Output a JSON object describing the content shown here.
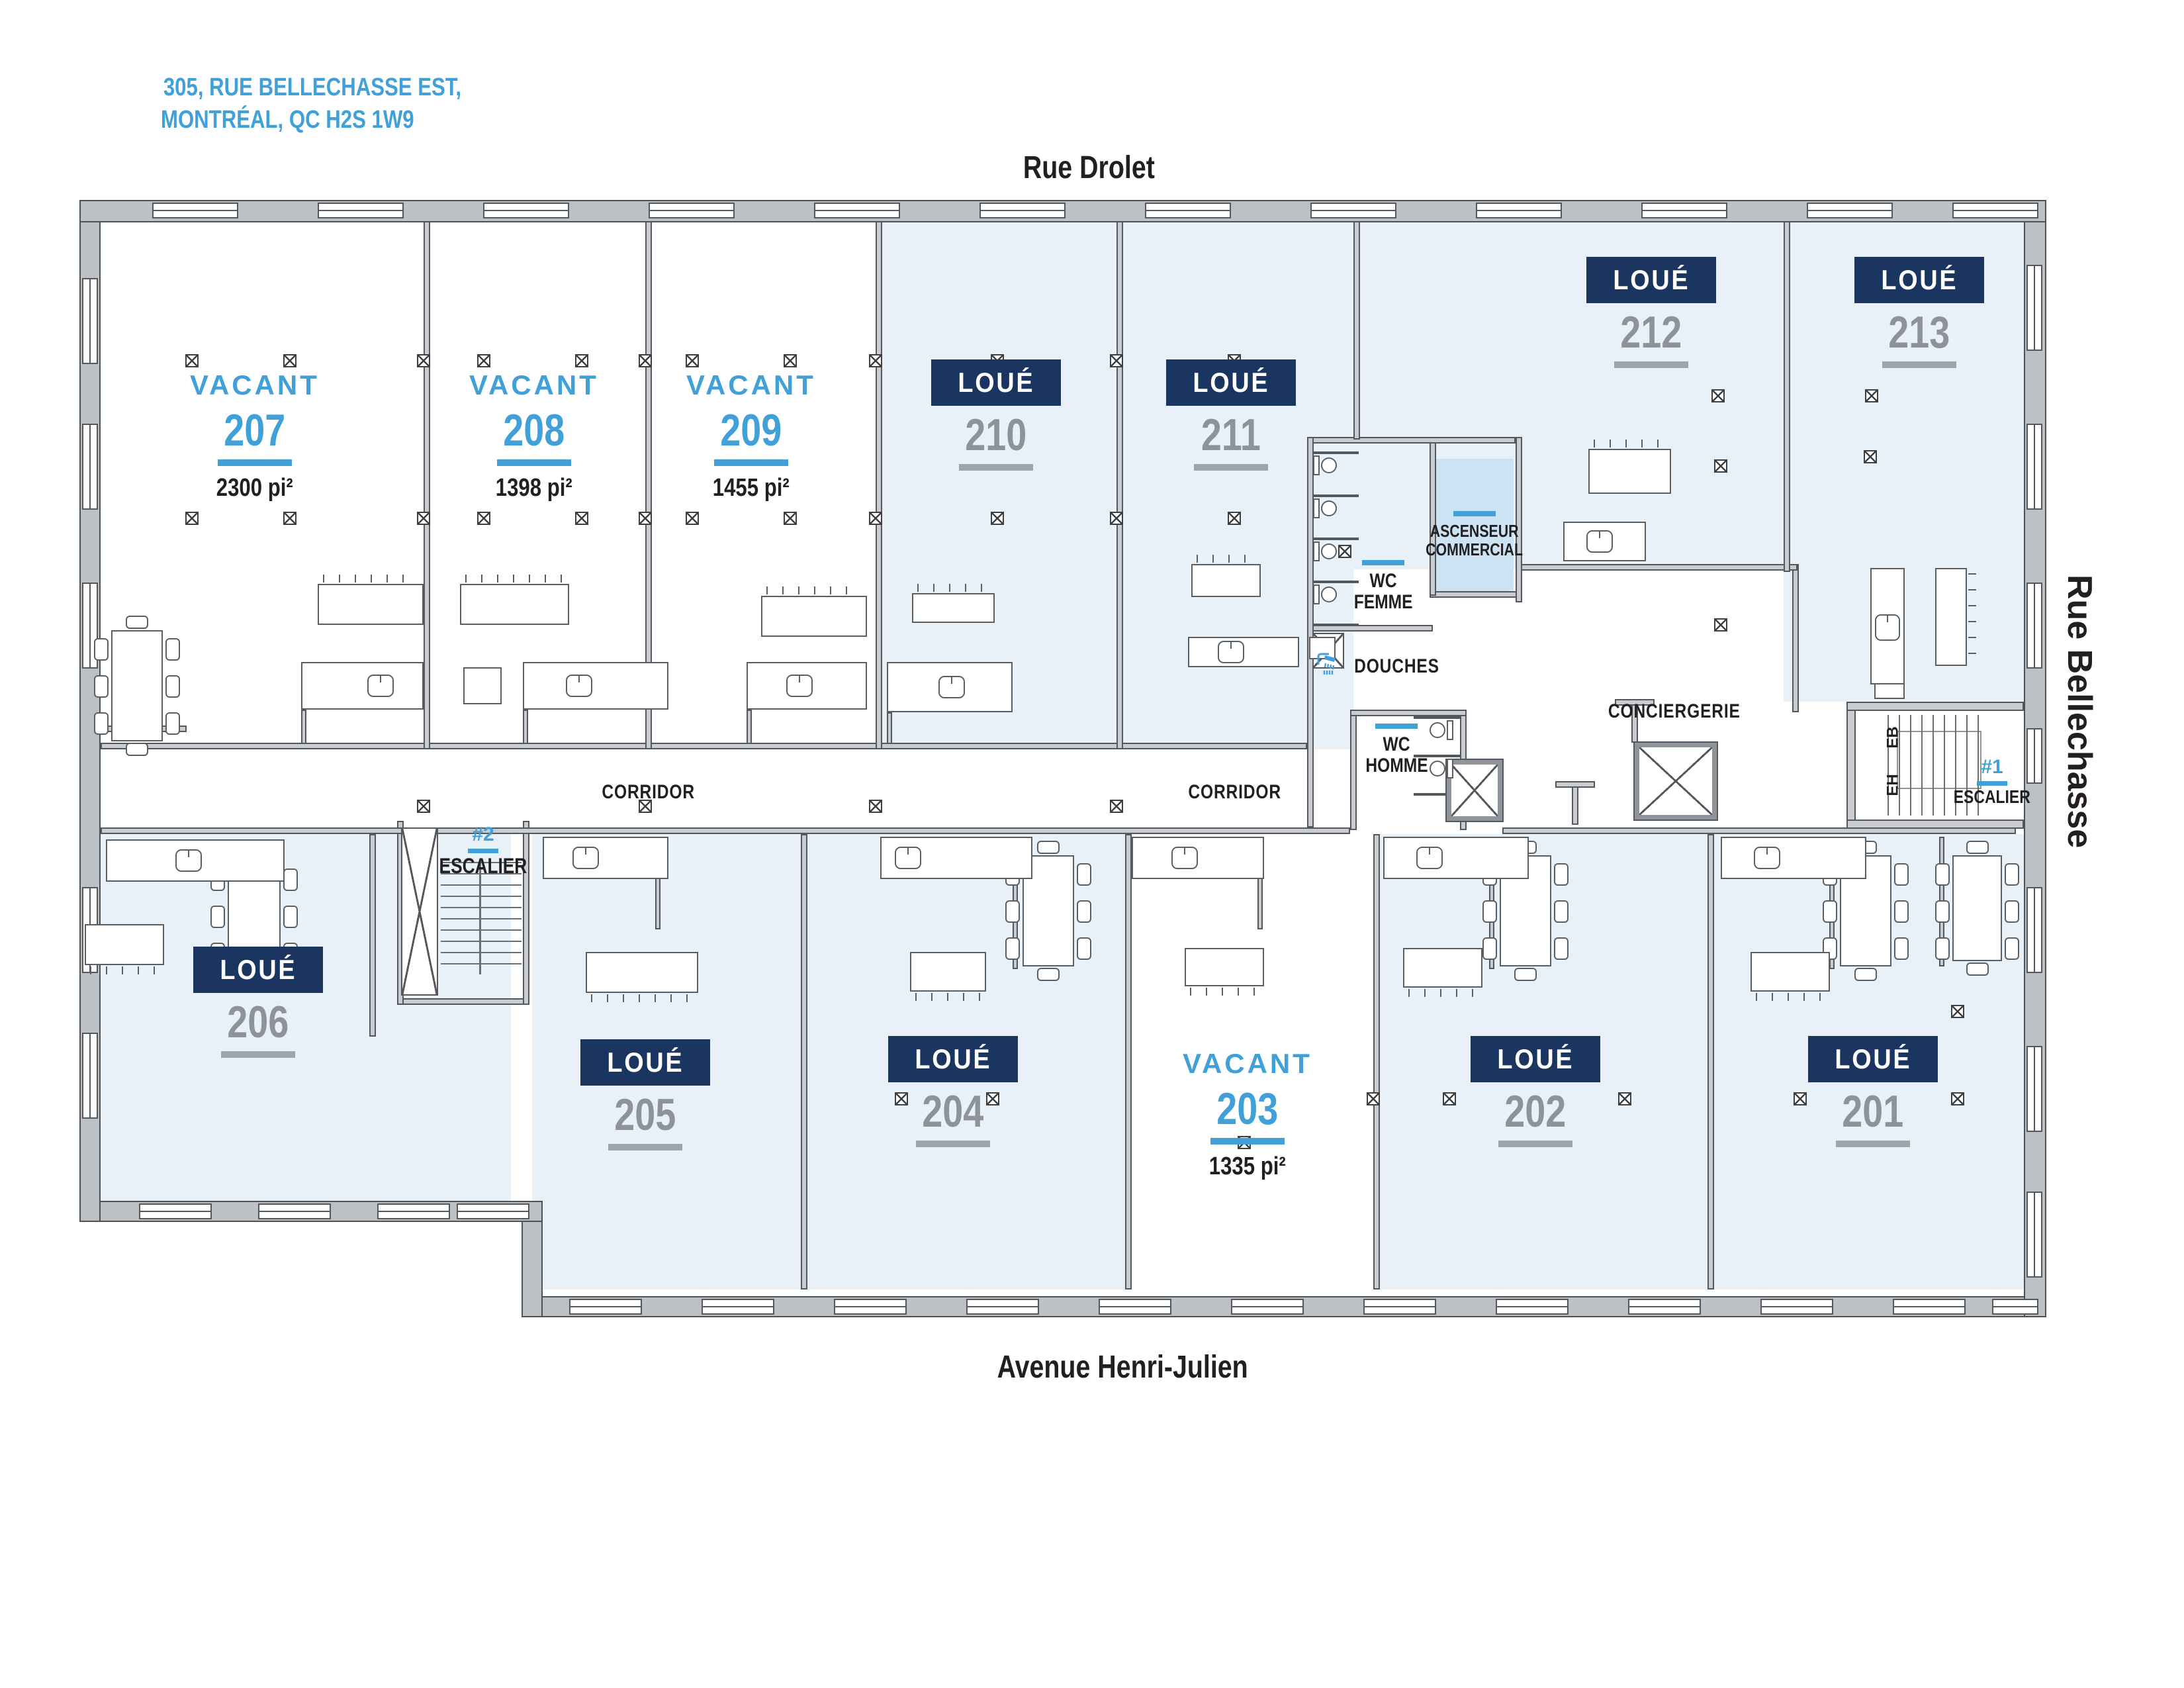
{
  "address": {
    "line1": "305, RUE BELLECHASSE EST,",
    "line2": "MONTRÉAL, QC H2S 1W9"
  },
  "streets": {
    "top": "Rue Drolet",
    "bottom": "Avenue Henri-Julien",
    "right": "Rue Bellechasse"
  },
  "labels": {
    "corridor_left": "CORRIDOR",
    "corridor_right": "CORRIDOR",
    "conciergerie": "CONCIERGERIE",
    "wc_femme_line1": "WC",
    "wc_femme_line2": "FEMME",
    "wc_homme_line1": "WC",
    "wc_homme_line2": "HOMME",
    "douches": "DOUCHES",
    "ascenseur_line1": "ASCENSEUR",
    "ascenseur_line2": "COMMERCIAL",
    "escalier1_num": "#1",
    "escalier1_label": "ESCALIER",
    "escalier2_num": "#2",
    "escalier2_label": "ESCALIER",
    "stair_eb": "EB",
    "stair_eh": "EH"
  },
  "status_legend": {
    "leased": "LOUÉ",
    "vacant": "VACANT"
  },
  "units": {
    "u201": {
      "number": "201",
      "status": "leased",
      "status_label": "LOUÉ"
    },
    "u202": {
      "number": "202",
      "status": "leased",
      "status_label": "LOUÉ"
    },
    "u203": {
      "number": "203",
      "status": "vacant",
      "status_label": "VACANT",
      "area": "1335 pi²"
    },
    "u204": {
      "number": "204",
      "status": "leased",
      "status_label": "LOUÉ"
    },
    "u205": {
      "number": "205",
      "status": "leased",
      "status_label": "LOUÉ"
    },
    "u206": {
      "number": "206",
      "status": "leased",
      "status_label": "LOUÉ"
    },
    "u207": {
      "number": "207",
      "status": "vacant",
      "status_label": "VACANT",
      "area": "2300 pi²"
    },
    "u208": {
      "number": "208",
      "status": "vacant",
      "status_label": "VACANT",
      "area": "1398 pi²"
    },
    "u209": {
      "number": "209",
      "status": "vacant",
      "status_label": "VACANT",
      "area": "1455 pi²"
    },
    "u210": {
      "number": "210",
      "status": "leased",
      "status_label": "LOUÉ"
    },
    "u211": {
      "number": "211",
      "status": "leased",
      "status_label": "LOUÉ"
    },
    "u212": {
      "number": "212",
      "status": "leased",
      "status_label": "LOUÉ"
    },
    "u213": {
      "number": "213",
      "status": "leased",
      "status_label": "LOUÉ"
    }
  },
  "colors": {
    "accent_blue": "#41A0D8",
    "navy": "#1A355F",
    "leased_fill": "#E8F1F8",
    "elevator_fill": "#CBE3F3",
    "number_gray": "#8D9398",
    "wall_gray": "#BCC1C5"
  }
}
